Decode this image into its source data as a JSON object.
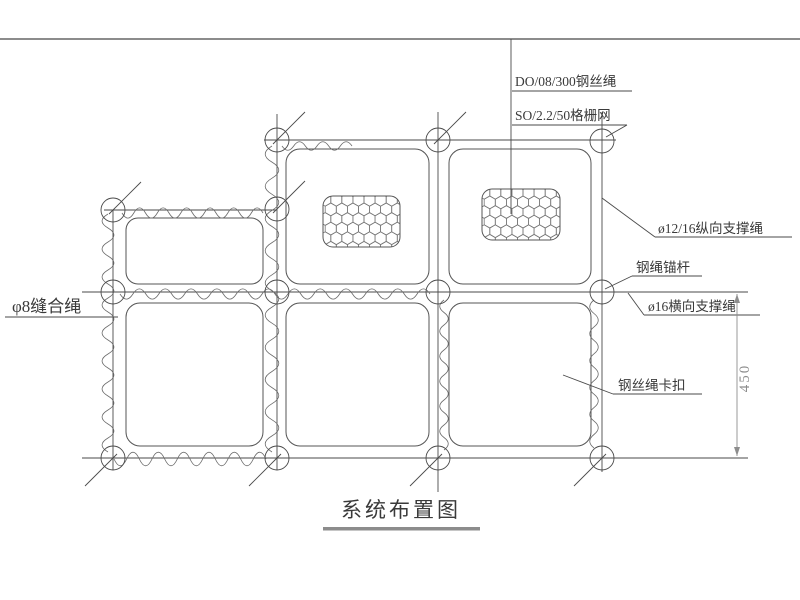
{
  "title": "系统布置图",
  "callouts": {
    "wire_rope": "DO/08/300钢丝绳",
    "grid_mesh": "SO/2.2/50格栅网",
    "longitudinal_rope": "ø12/16纵向支撑绳",
    "rope_anchor": "钢绳锚杆",
    "transverse_rope": "ø16横向支撑绳",
    "rope_clip": "钢丝绳卡扣",
    "seam_rope": "φ8缝合绳"
  },
  "dimensions": {
    "panel_height": "450"
  },
  "colors": {
    "line": "#4a4a4a",
    "mesh": "#8a8a8a",
    "frame": "#8c8c8c",
    "text": "#3a3a3a"
  }
}
